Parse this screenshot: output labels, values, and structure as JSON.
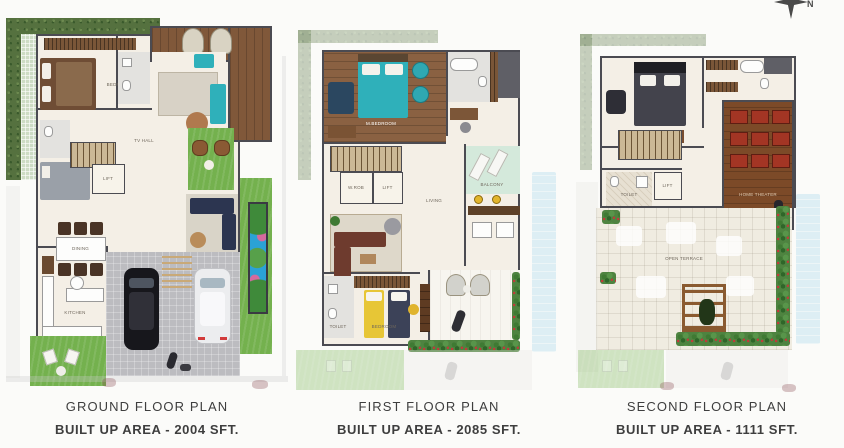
{
  "sheet": {
    "compass_north_label": "N"
  },
  "plans": [
    {
      "title": "GROUND FLOOR PLAN",
      "area": "BUILT UP AREA - 2004 SFT.",
      "rooms": {
        "bedroom": "BEDROOM",
        "tv_hall": "TV HALL",
        "lift": "LIFT",
        "dining": "DINING",
        "kitchen": "KITCHEN"
      }
    },
    {
      "title": "FIRST FLOOR PLAN",
      "area": "BUILT UP AREA - 2085 SFT.",
      "rooms": {
        "master_bedroom": "M.BEDROOM",
        "wardrobe": "W.ROB",
        "lift": "LIFT",
        "living": "LIVING",
        "balcony": "BALCONY",
        "bedroom": "BEDROOM",
        "toilet": "TOILET"
      }
    },
    {
      "title": "SECOND FLOOR PLAN",
      "area": "BUILT UP AREA - 1111 SFT.",
      "rooms": {
        "bedroom": "BEDROOM",
        "home_theater": "HOME THEATER",
        "lift": "LIFT",
        "toilet": "TOILET",
        "terrace": "OPEN TERRACE"
      }
    }
  ],
  "palette": {
    "lawn_green": "#74b14e",
    "hedge_green": "#55713f",
    "pool_blue": "#2ba2d6",
    "teal_accent": "#2fb0ba",
    "theater_red": "#a33524",
    "bed_yellow": "#e7c636",
    "wall_gray": "#4b4b52",
    "caption_text": "#3e3e3e"
  }
}
